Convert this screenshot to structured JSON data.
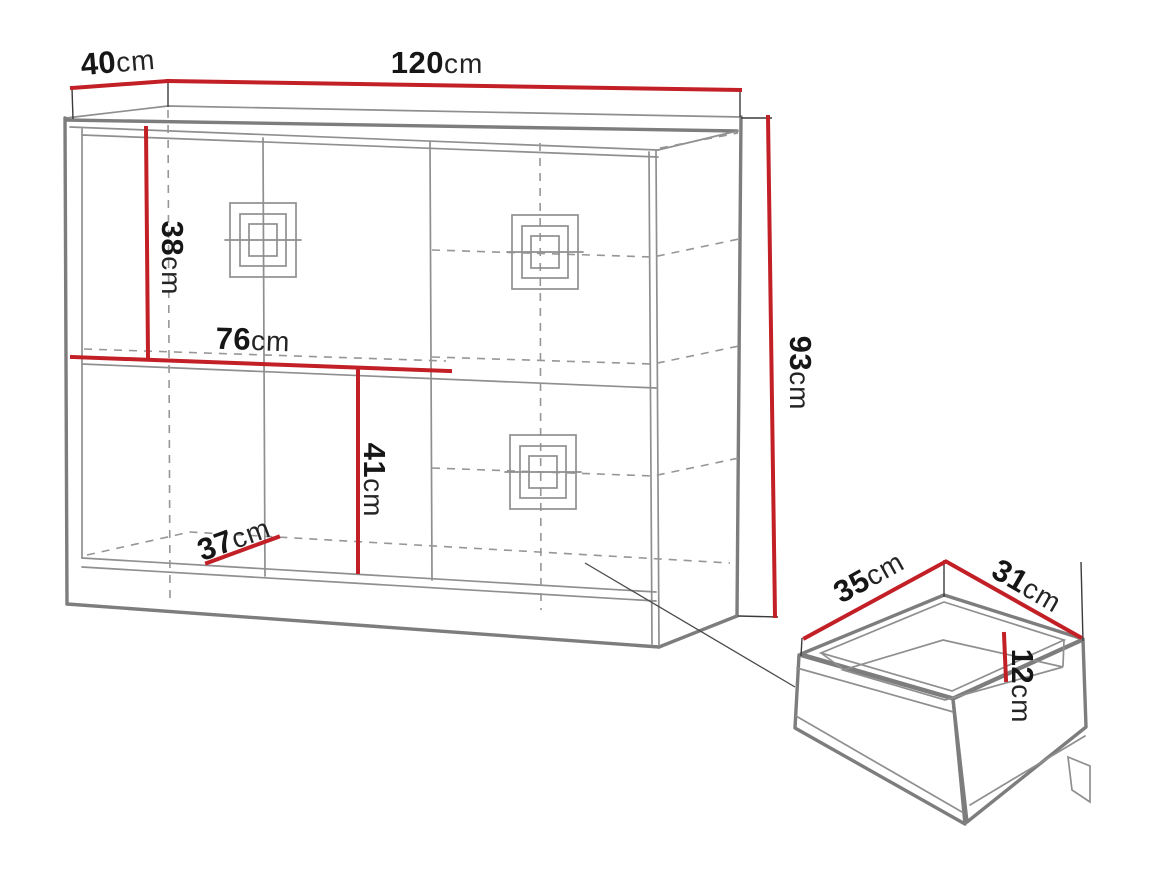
{
  "figure": {
    "type": "furniture-dimension-diagram",
    "subject": "sideboard with door section, drawer section and separate drawer-box detail",
    "unit": "cm"
  },
  "colors": {
    "dimension": "#c22026",
    "outline": "#7d7d7d",
    "outline-light": "#8f8f8f",
    "dashed": "#969696",
    "text": "#161616",
    "background": "#ffffff"
  },
  "dimensions": {
    "depth": {
      "value": "40",
      "unit": "cm"
    },
    "width": {
      "value": "120",
      "unit": "cm"
    },
    "height": {
      "value": "93",
      "unit": "cm"
    },
    "upper_interior_height": {
      "value": "38",
      "unit": "cm"
    },
    "interior_width": {
      "value": "76",
      "unit": "cm"
    },
    "lower_interior_height": {
      "value": "41",
      "unit": "cm"
    },
    "interior_depth": {
      "value": "37",
      "unit": "cm"
    },
    "drawer_width": {
      "value": "35",
      "unit": "cm"
    },
    "drawer_depth": {
      "value": "31",
      "unit": "cm"
    },
    "drawer_height": {
      "value": "12",
      "unit": "cm"
    }
  }
}
